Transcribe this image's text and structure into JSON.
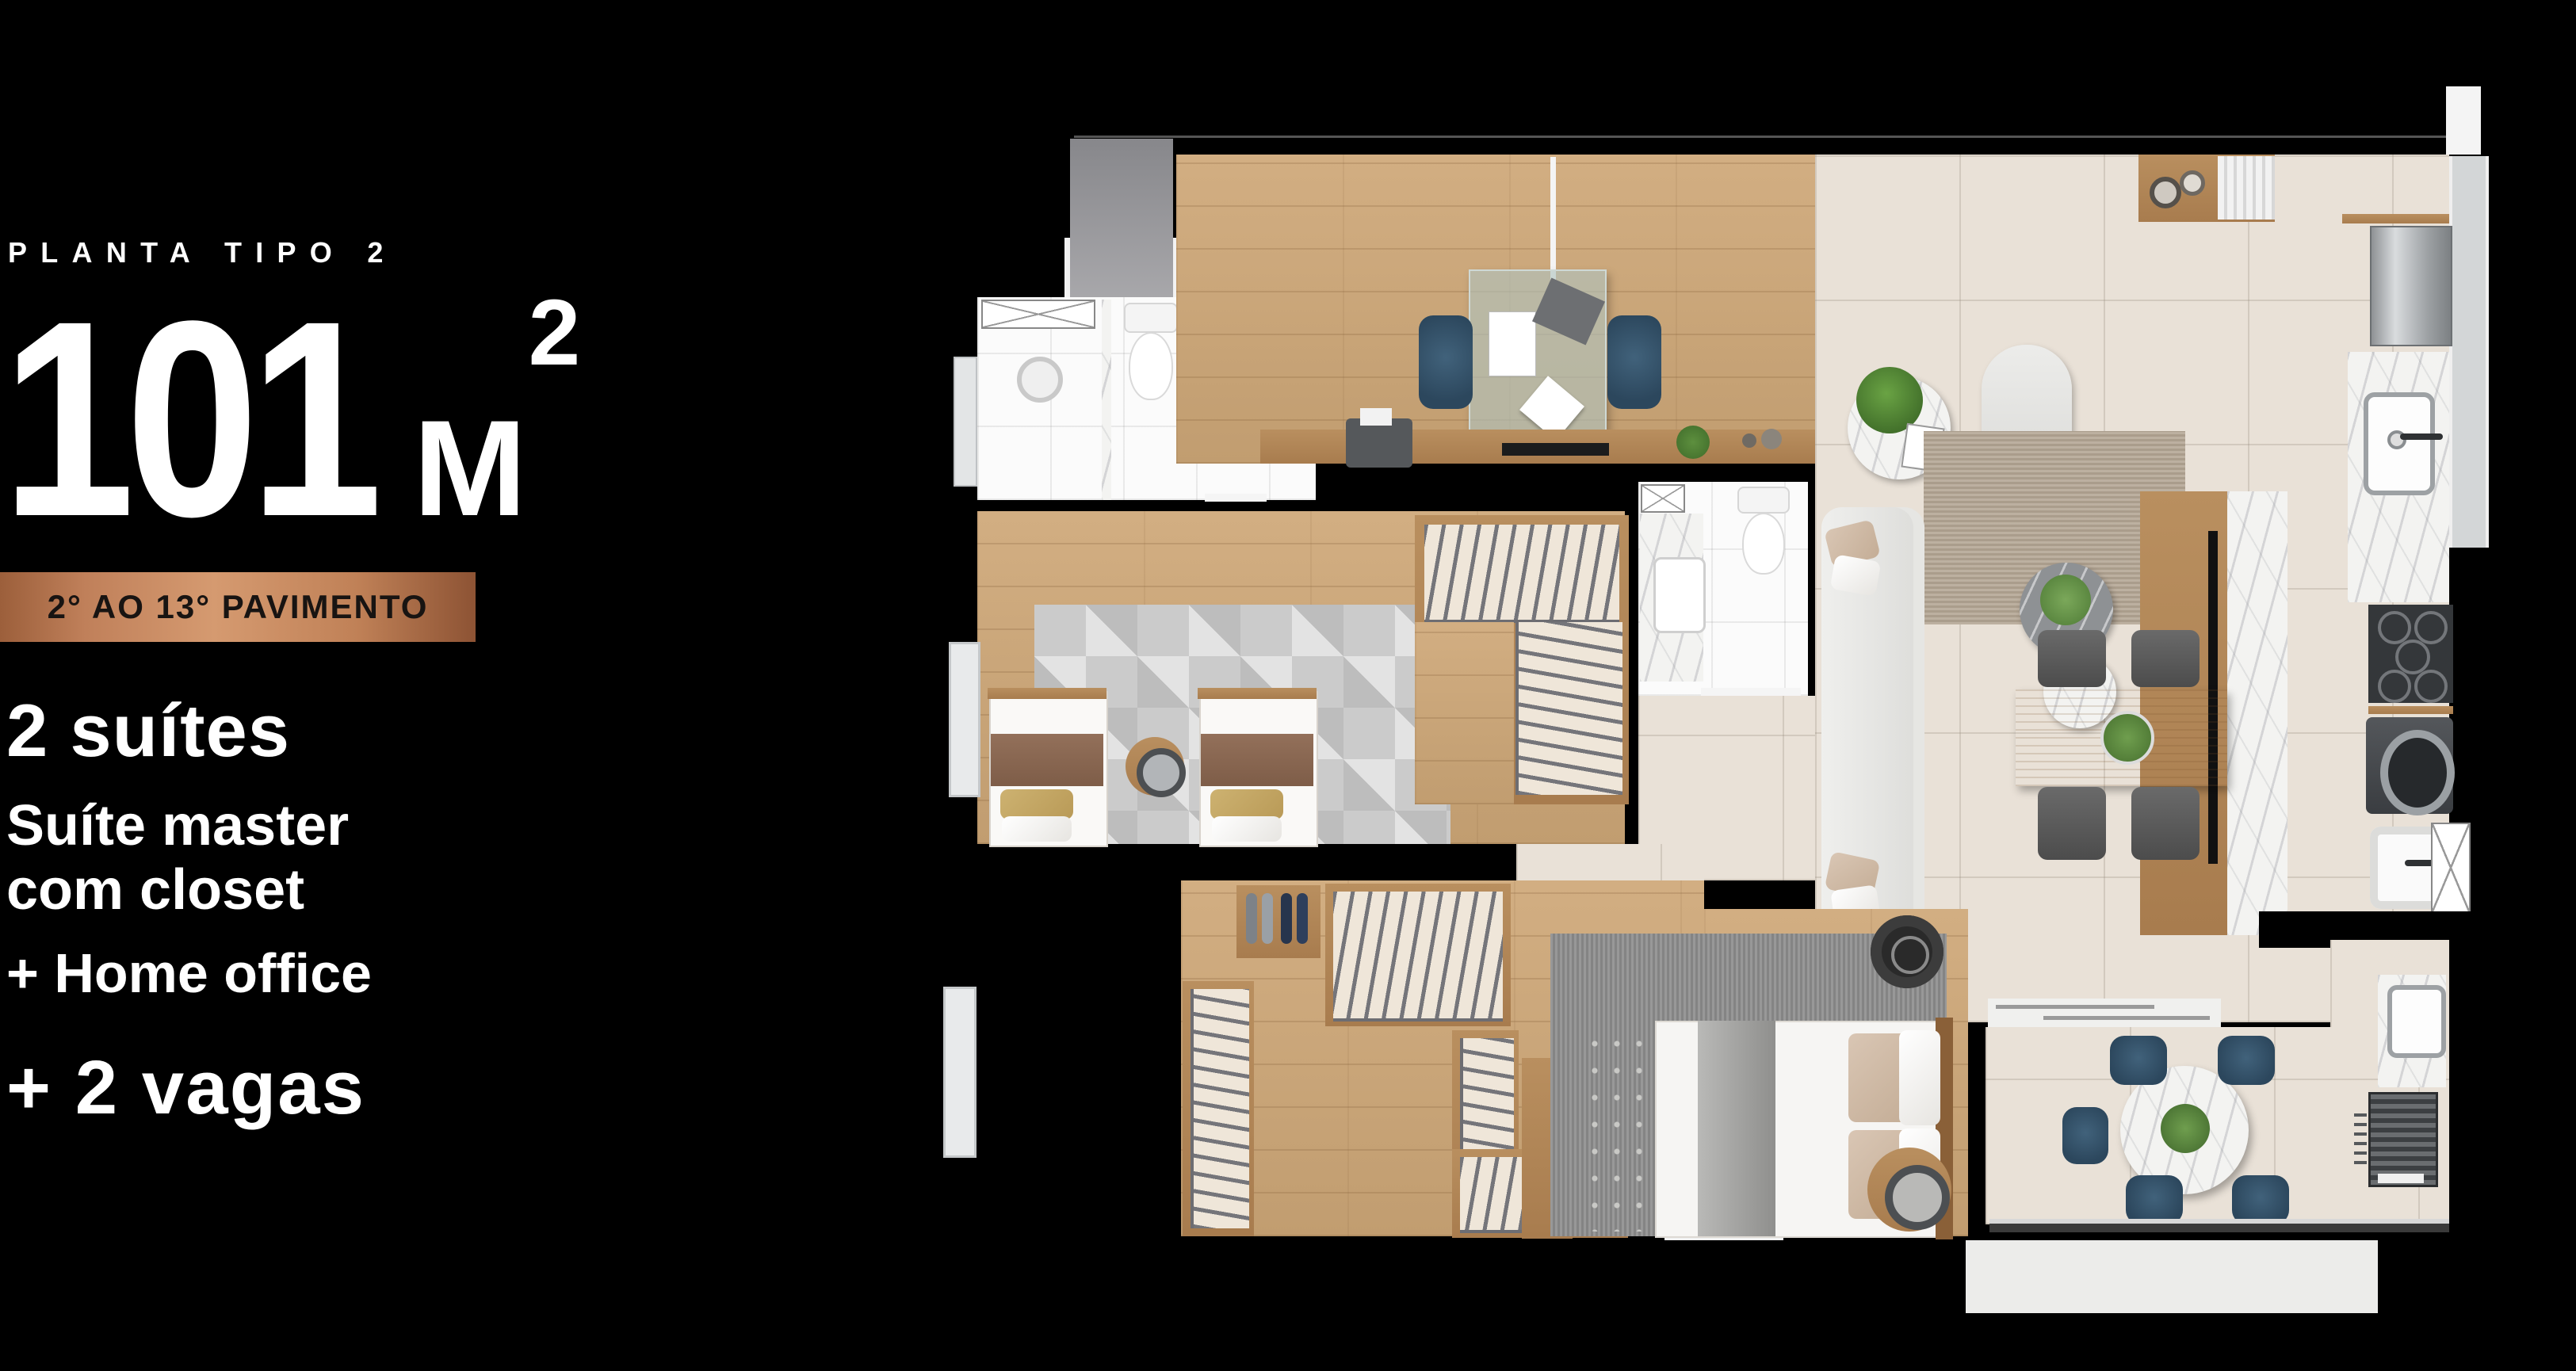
{
  "left_panel": {
    "plan_type": "PLANTA TIPO 2",
    "area": {
      "value": "101",
      "unit": "M",
      "sup": "2"
    },
    "floor_banner": "2° AO 13° PAVIMENTO",
    "features": [
      {
        "text": "2 suítes"
      },
      {
        "line1": "Suíte master",
        "line2": "com closet"
      },
      {
        "text": "+ Home office"
      },
      {
        "text": "+ 2 vagas"
      }
    ]
  },
  "colors": {
    "background": "#000000",
    "banner_copper": [
      "#9c5f3b",
      "#d59a70",
      "#8d5334"
    ],
    "banner_text": "#181412",
    "wood_floor": "#c9a274",
    "beige_tile": "#e9e1d7",
    "white_tile": "#fbfbfb",
    "wall": "#000000",
    "marble": "#f3f3f1",
    "accent_chair_blue": "#35536a",
    "rug_gray": "#c7c7c7",
    "rug_taupe": "#b5a795"
  },
  "floor_plan": {
    "rooms": [
      "entry-hall",
      "home-office",
      "bathroom-1",
      "suite-2-bedroom",
      "suite-2-closet",
      "suite-2-bathroom",
      "hallway",
      "living-room",
      "dining-area",
      "kitchen",
      "laundry",
      "master-suite",
      "master-closet",
      "terrace-gourmet",
      "balcony-edge"
    ],
    "furniture_icons": [
      "desk-icon",
      "office-chair-icon",
      "laptop-icon",
      "printer-icon",
      "tv-icon",
      "single-bed-icon",
      "double-bed-icon",
      "nightstand-icon",
      "wardrobe-rail-icon",
      "shoe-rack-icon",
      "sofa-icon",
      "armchair-icon",
      "coffee-table-icon",
      "rug-icon",
      "sideboard-icon",
      "dining-table-icon",
      "dining-chair-icon",
      "plant-icon",
      "fridge-icon",
      "sink-icon",
      "cooktop-icon",
      "washer-icon",
      "laundry-tub-icon",
      "toilet-icon",
      "shower-icon",
      "round-table-icon",
      "grill-icon",
      "bench-icon",
      "glass-railing-icon"
    ]
  }
}
